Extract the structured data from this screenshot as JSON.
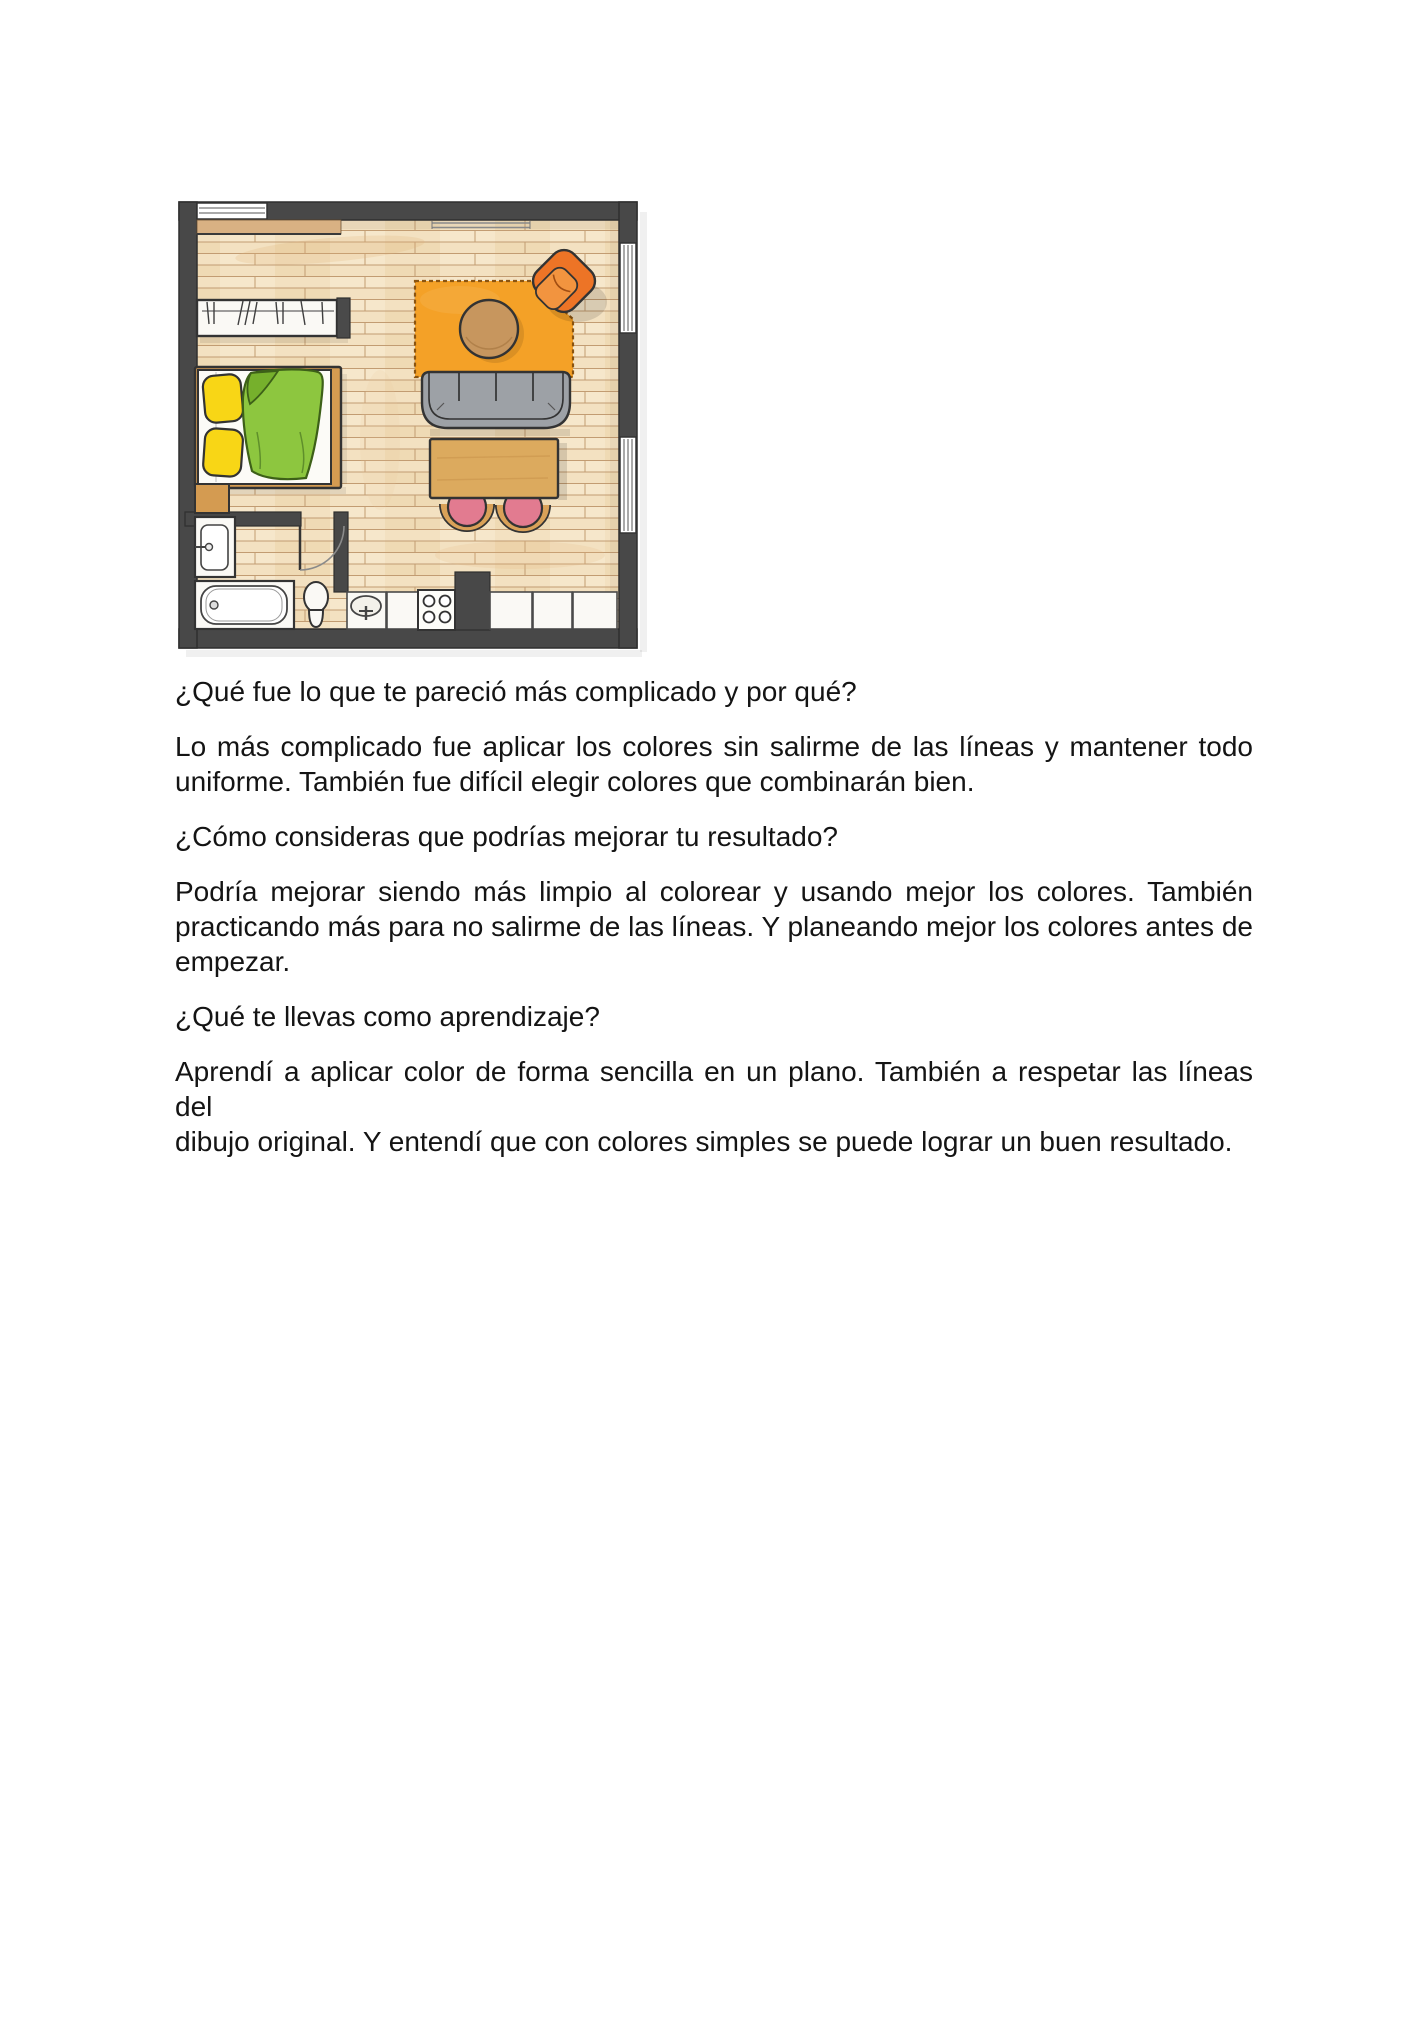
{
  "document": {
    "language": "es",
    "blocks": [
      {
        "type": "question",
        "lines": [
          "¿Qué fue lo que te pareció más complicado y por qué?"
        ]
      },
      {
        "type": "answer",
        "lines": [
          "Lo más complicado fue aplicar los colores sin salirme de las líneas y mantener todo",
          "uniforme. También fue difícil elegir colores que combinarán bien."
        ]
      },
      {
        "type": "question",
        "lines": [
          "¿Cómo consideras que podrías mejorar tu resultado?"
        ]
      },
      {
        "type": "answer",
        "lines": [
          "Podría mejorar siendo más limpio al colorear y usando mejor los colores. También",
          "practicando más para no salirme de las líneas. Y planeando mejor los colores antes de",
          "empezar."
        ]
      },
      {
        "type": "question",
        "lines": [
          "¿Qué te llevas como aprendizaje?"
        ]
      },
      {
        "type": "answer",
        "lines": [
          "Aprendí a aplicar color de forma sencilla en un plano. También a respetar las líneas del",
          "dibujo original. Y entendí que con colores simples se puede lograr un buen resultado."
        ]
      }
    ]
  },
  "floor_plan": {
    "type": "hand-drawn watercolor studio apartment floor plan",
    "rooms": [
      "bedroom area",
      "living-dining area",
      "bathroom",
      "kitchen"
    ],
    "items": [
      "top-wall window",
      "wardrobe with hangers",
      "double bed with green duvet and two yellow pillows",
      "wood bench",
      "orange area rug",
      "round wooden coffee table",
      "orange armchair",
      "gray sofa",
      "wooden dining table",
      "two pink stools",
      "bathroom vanity sink",
      "bathtub",
      "toilet",
      "interior door",
      "kitchen sink",
      "four-burner stove",
      "kitchen counters",
      "two right-wall windows",
      "wall rail"
    ],
    "colors": {
      "wall": "#484848",
      "floor": "#f3e1c1",
      "floor_line": "#c29c72",
      "rug": "#f4a127",
      "armchair": "#ed7426",
      "armchair_seat": "#f2943f",
      "sofa": "#9da1a6",
      "coffee_table": "#c7965e",
      "dining_table": "#dcaa5e",
      "stool_pink": "#e27b90",
      "stool_wood": "#d9a158",
      "duvet": "#8dc63f",
      "duvet_fold": "#76b02c",
      "pillow": "#f8d616",
      "bed_frame": "#d49b51",
      "fixture_white": "#faf9f5",
      "shelf": "#d9b183"
    }
  }
}
